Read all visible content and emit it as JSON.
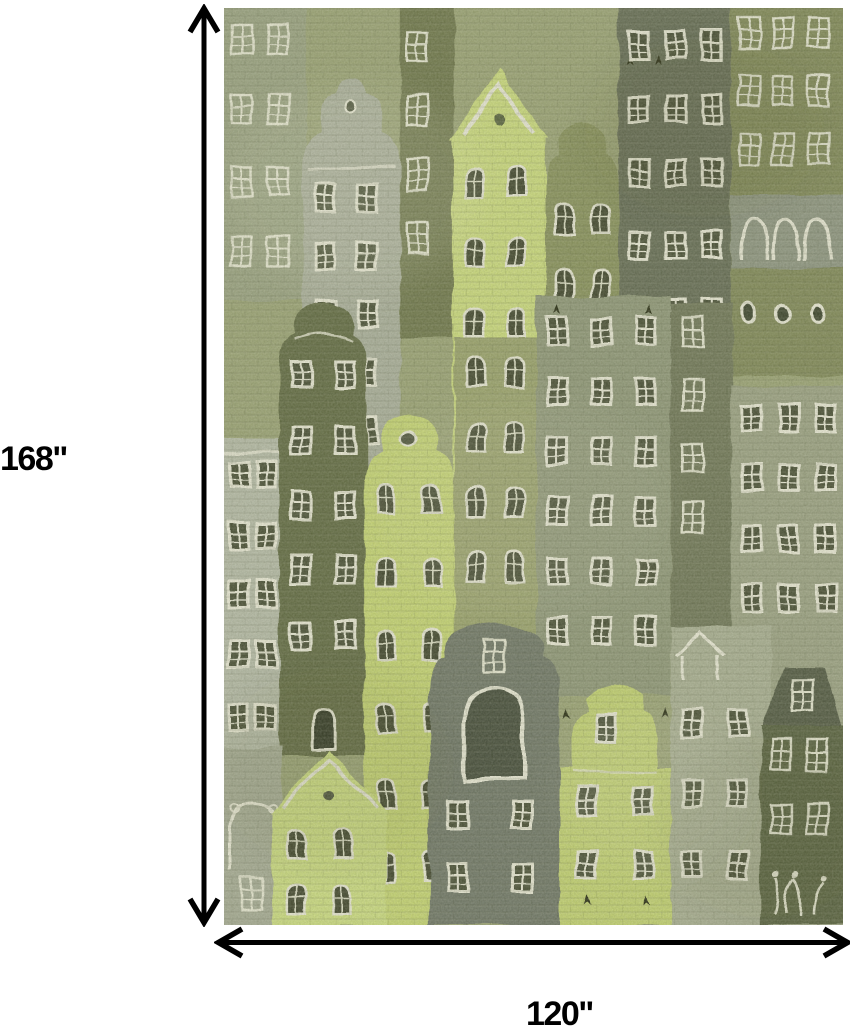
{
  "figure": {
    "description": "green watercolor cityscape area rug with dimension arrows"
  },
  "dimensions": {
    "height_label": "168\"",
    "width_label": "120\"",
    "arrow_color": "#000000"
  },
  "rug_palette": {
    "base_sage": "#9aa274",
    "chartreuse": "#cbda7c",
    "bright_chartreuse": "#c6d572",
    "pale_gray_green": "#b5baa7",
    "gray": "#a9ae9b",
    "olive": "#87905a",
    "dark_olive": "#5f673f",
    "dark_gray_green": "#646a53",
    "window_trim": "#e9e8d6",
    "window_dark": "#3c422c"
  }
}
